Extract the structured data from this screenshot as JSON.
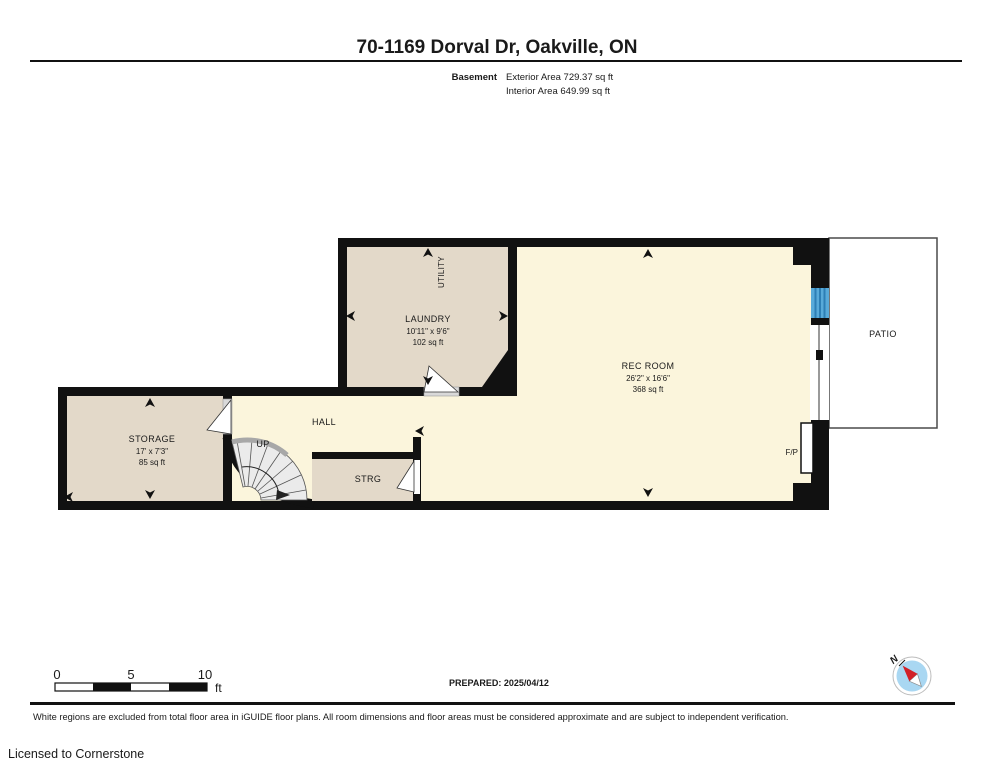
{
  "title": "70-1169 Dorval Dr, Oakville, ON",
  "header": {
    "floor_label": "Basement",
    "exterior_area": "Exterior Area 729.37 sq ft",
    "interior_area": "Interior Area 649.99 sq ft"
  },
  "rooms": {
    "laundry": {
      "name": "LAUNDRY",
      "dims": "10'11\" x 9'6\"",
      "area": "102 sq ft"
    },
    "utility_label": "UTILITY",
    "rec_room": {
      "name": "REC ROOM",
      "dims": "26'2\" x 16'6\"",
      "area": "368 sq ft"
    },
    "storage": {
      "name": "STORAGE",
      "dims": "17' x 7'3\"",
      "area": "85 sq ft"
    },
    "hall_label": "HALL",
    "up_label": "UP",
    "strg_label": "STRG",
    "fireplace_label": "F/P",
    "patio_label": "PATIO"
  },
  "scale_bar": {
    "labels": [
      "0",
      "5",
      "10"
    ],
    "unit": "ft"
  },
  "prepared_label": "PREPARED: 2025/04/12",
  "compass": {
    "north_label": "N"
  },
  "footer": {
    "disclaimer": "White regions are excluded from total floor area in iGUIDE floor plans. All room dimensions and floor areas must be considered approximate and are subject to independent verification.",
    "license": "Licensed to Cornerstone"
  },
  "colors": {
    "wall": "#111111",
    "room_warm": "#e3d9c9",
    "room_light": "#fbf5dc",
    "window_blue": "#58aad9",
    "window_blue_dark": "#2d7fb5",
    "stair_fill": "#ebebeb",
    "compass_blue": "#a9d7f2",
    "compass_red": "#d22027",
    "license_gray": "#9c9c9c"
  }
}
